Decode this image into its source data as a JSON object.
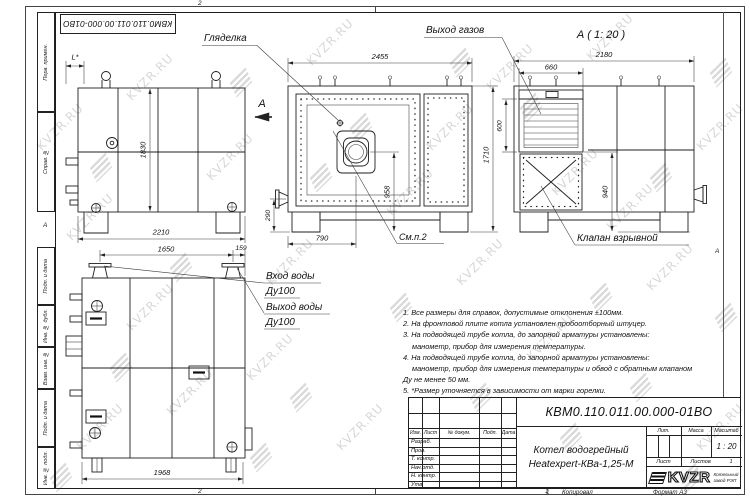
{
  "sheet": {
    "stamp_top": "КВМ0.110.011.00.000-01ВО",
    "zones": {
      "top": "2",
      "bottom_left": "2",
      "bottom_right": "1",
      "left": "А",
      "right": "А"
    },
    "footer": {
      "num": "1",
      "copied": "Копировал",
      "format": "Формат А3"
    }
  },
  "margin_labels": [
    "Перв. примен.",
    "Справ. №",
    "Подп. и дата",
    "Инв. № дубл.",
    "Взам. инв. №",
    "Подп. и дата",
    "Инв. № подл."
  ],
  "watermark": {
    "text": "KVZR.RU"
  },
  "callouts": {
    "sight_glass": "Гляделка",
    "gas_outlet": "Выход газов",
    "section": "А ( 1: 20 )",
    "section_arrow": "А",
    "see_note": "См.п.2",
    "explosion_valve": "Клапан взрывной",
    "water_in": "Вход воды",
    "water_in_dn": "Ду100",
    "water_out": "Выход воды",
    "water_out_dn": "Ду100"
  },
  "dims": {
    "l_star": "L*",
    "h1830": "1830",
    "w2210": "2210",
    "w2455": "2455",
    "h958": "958",
    "w790": "790",
    "h290": "290",
    "h1710": "1710",
    "w2180": "2180",
    "w660": "660",
    "h600": "600",
    "h940": "940",
    "w1650": "1650",
    "w159": "159",
    "w1968": "1968"
  },
  "notes": {
    "lines": [
      "1. Все размеры для справок, допустимые отклонения ±100мм.",
      "2. На фронтовой плите котла установлен пробоотборный штуцер.",
      "3. На подводящей трубе котла, до запорной арматуры установлены:",
      "манометр, прибор для измерения температуры.",
      "4. На подводящей трубе котла, до запорной арматуры установлены:",
      "манометр, прибор для измерения температуры и обвод с обратным клапаном",
      "Ду не менее 50 мм.",
      "5. *Размер уточняется в зависимости от марки горелки."
    ]
  },
  "titleblock": {
    "doc_number": "КВМ0.110.011.00.000-01ВО",
    "title_line1": "Котел водогрейный",
    "title_line2": "Heatexpert-КВа-1,25-М",
    "header_cols": [
      "Изм.",
      "Лист",
      "№ докум.",
      "Подп.",
      "Дата"
    ],
    "rows": [
      "Разраб.",
      "Пров.",
      "Т. контр.",
      "Нач.отд.",
      "Н. контр.",
      "Утв."
    ],
    "lit_label": "Лит.",
    "mass_label": "Масса",
    "scale_label": "Масштаб",
    "scale_value": "1 : 20",
    "sheet_label": "Лист",
    "sheets_label": "Листов",
    "sheets_value": "1",
    "logo_text": "KVZR",
    "company_line1": "Котельный",
    "company_line2": "завод РЭП"
  }
}
